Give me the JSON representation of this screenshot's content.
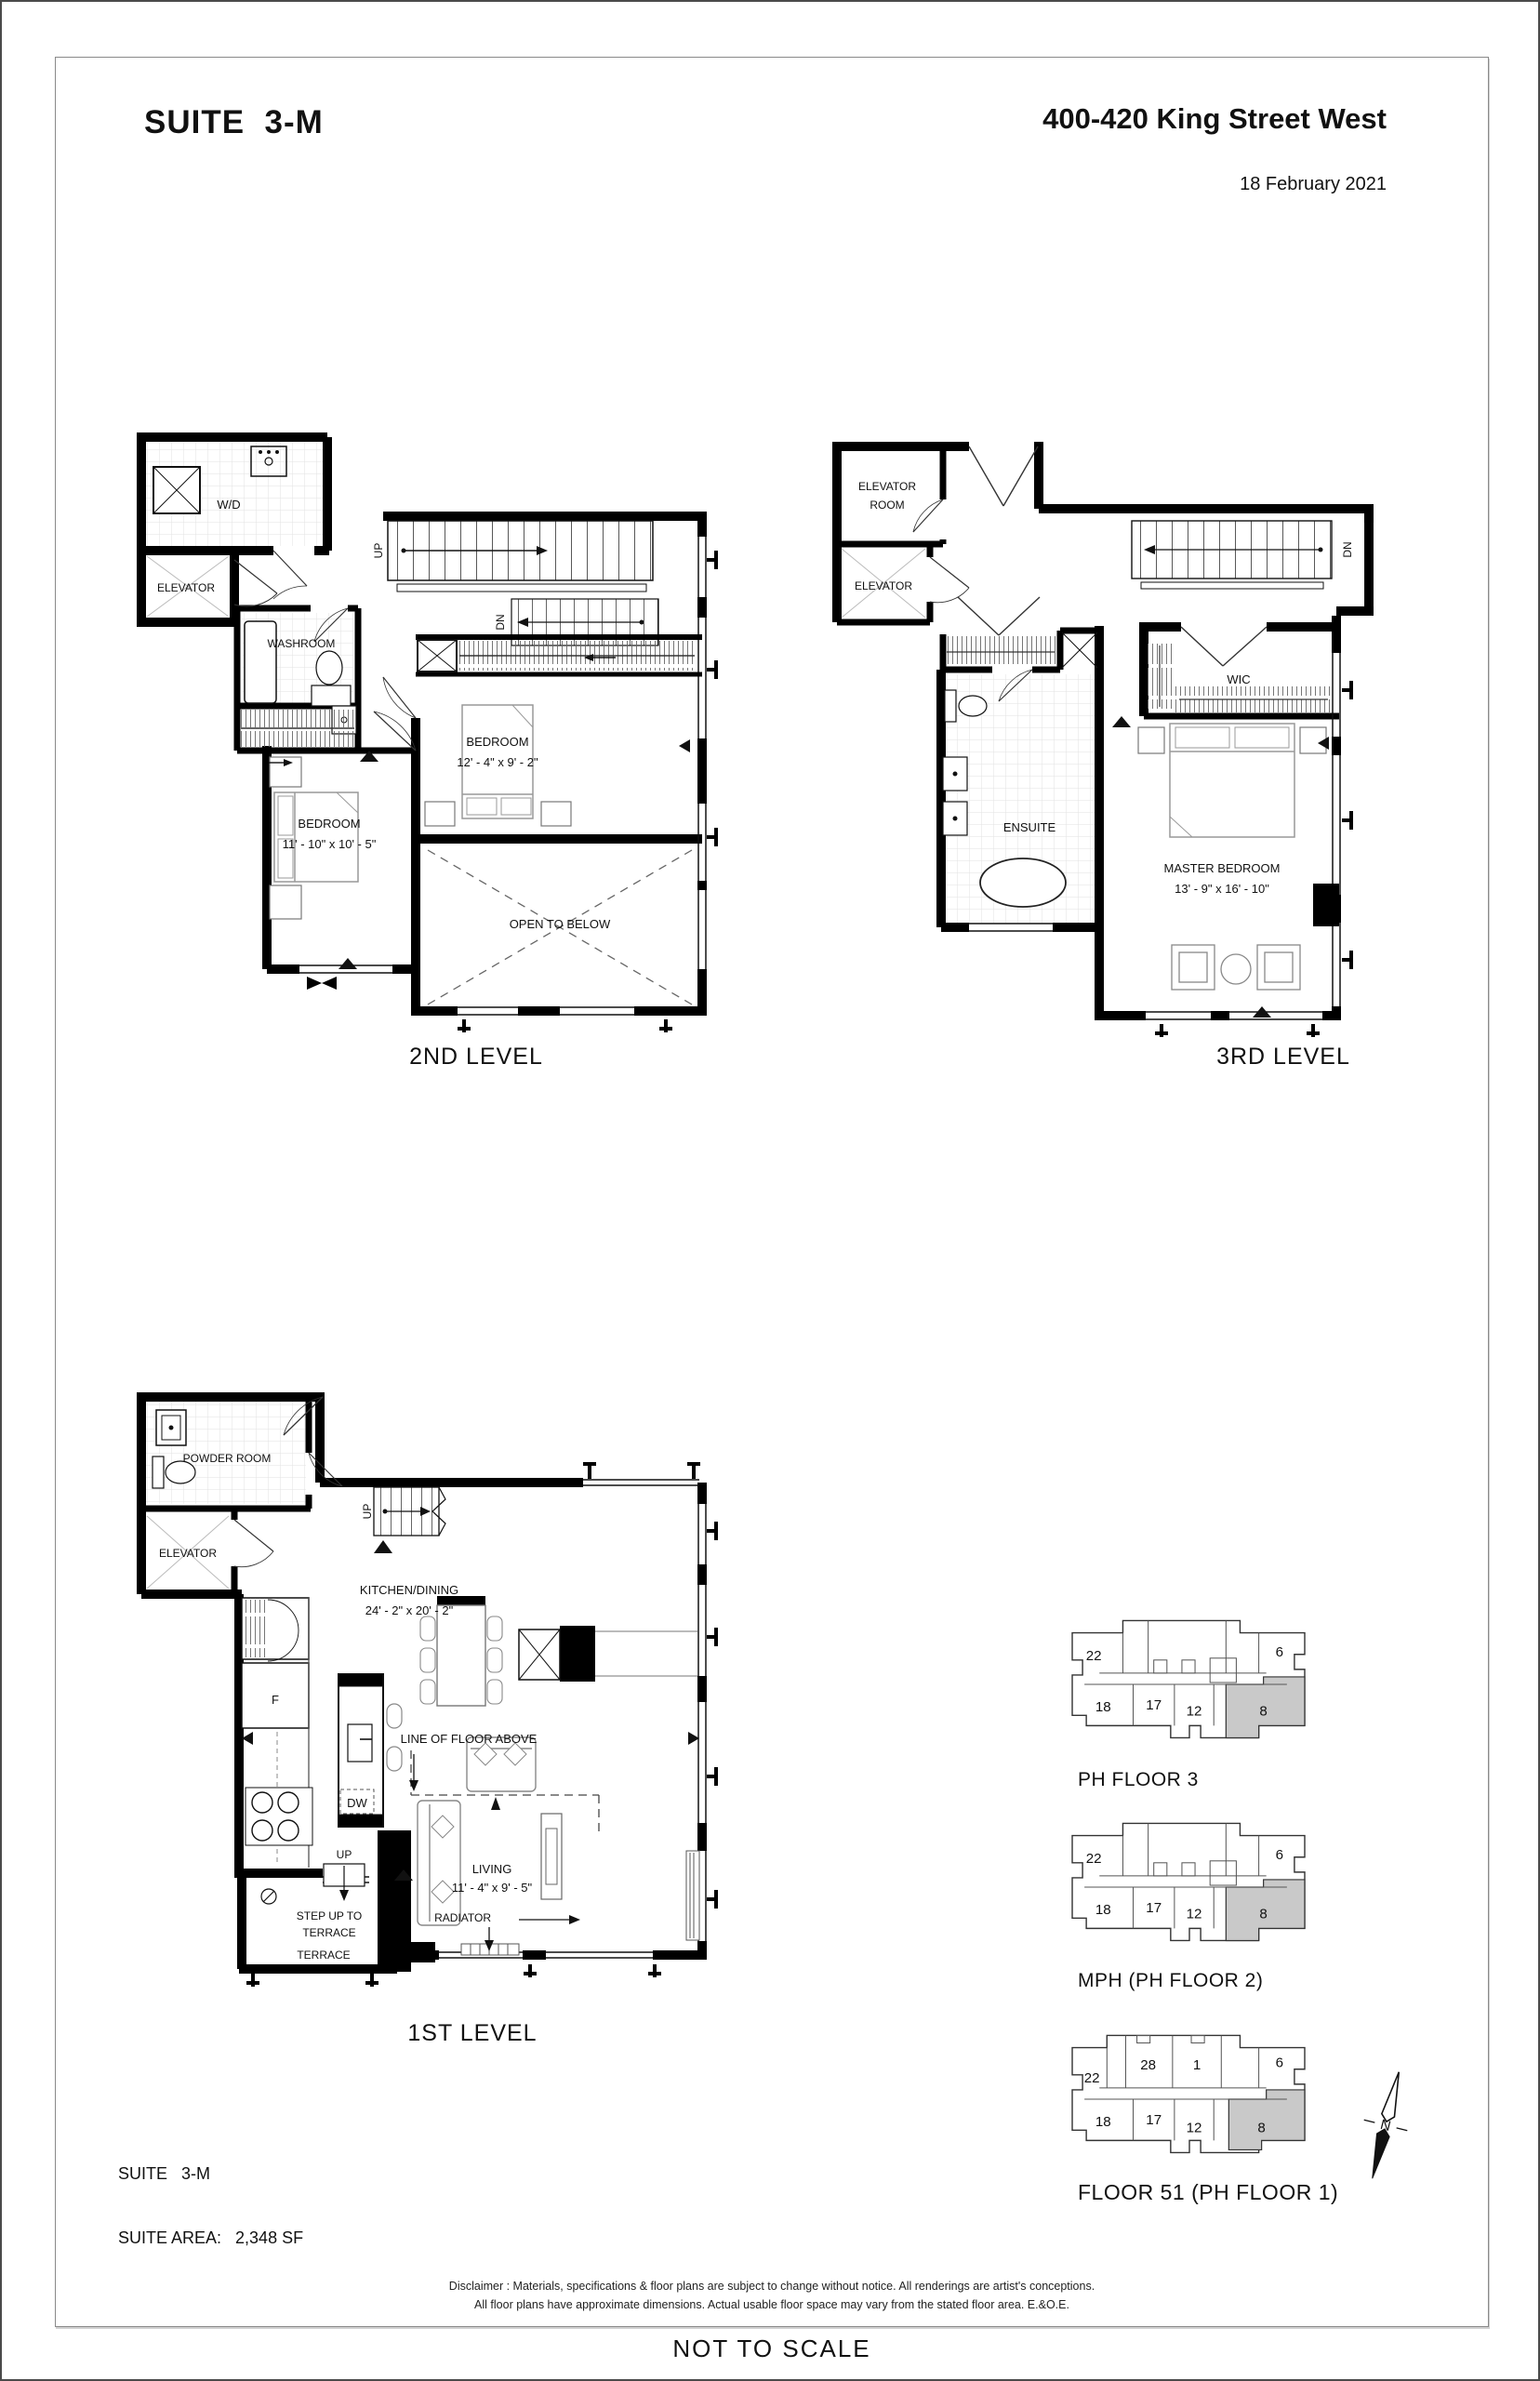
{
  "page": {
    "title": "SUITE  3-M",
    "address": "400-420 King Street West",
    "date": "18 February 2021",
    "not_to_scale": "NOT TO SCALE",
    "disclaimer": [
      "Disclaimer : Materials, specifications & floor plans are subject to change without notice. All renderings are artist's conceptions.",
      "All floor plans have approximate dimensions. Actual usable floor space may vary from the stated floor area. E.&O.E."
    ]
  },
  "suite_info": {
    "line1": "SUITE   3-M",
    "line2": "SUITE AREA:   2,348 SF"
  },
  "levels": {
    "second": {
      "title": "2ND LEVEL",
      "labels": {
        "wd": "W/D",
        "elevator": "ELEVATOR",
        "washroom": "WASHROOM",
        "up": "UP",
        "dn": "DN",
        "bedroom2_name": "BEDROOM",
        "bedroom2_dims": "12' - 4\"  x  9' - 2\"",
        "bedroom1_name": "BEDROOM",
        "bedroom1_dims": "11' - 10\"  x  10' - 5\"",
        "open_below": "OPEN TO BELOW"
      }
    },
    "third": {
      "title": "3RD LEVEL",
      "labels": {
        "elevator_room_line1": "ELEVATOR",
        "elevator_room_line2": "ROOM",
        "elevator": "ELEVATOR",
        "dn": "DN",
        "wic": "WIC",
        "ensuite": "ENSUITE",
        "master_name": "MASTER BEDROOM",
        "master_dims": "13' - 9\"  x  16' - 10\""
      }
    },
    "first": {
      "title": "1ST LEVEL",
      "labels": {
        "powder": "POWDER ROOM",
        "elevator": "ELEVATOR",
        "up_stairs": "UP",
        "kitchen_name": "KITCHEN/DINING",
        "kitchen_dims": "24' - 2\"  x  20' - 2\"",
        "fridge": "F",
        "dw": "DW",
        "line_above": "LINE OF FLOOR ABOVE",
        "living_name": "LIVING",
        "living_dims": "11' - 4\"  x  9' - 5\"",
        "radiator": "RADIATOR",
        "up_step": "UP",
        "step_line1": "STEP UP TO",
        "step_line2": "TERRACE",
        "terrace": "TERRACE"
      }
    }
  },
  "keyplans": [
    {
      "label": "PH FLOOR 3",
      "units": [
        "22",
        "6",
        "18",
        "17",
        "12",
        "8"
      ],
      "highlighted_unit": "8"
    },
    {
      "label": "MPH (PH FLOOR 2)",
      "units": [
        "22",
        "6",
        "18",
        "17",
        "12",
        "8"
      ],
      "highlighted_unit": "8"
    },
    {
      "label": "FLOOR 51 (PH FLOOR 1)",
      "units": [
        "22",
        "28",
        "1",
        "6",
        "18",
        "17",
        "12",
        "8"
      ],
      "highlighted_unit": "8"
    }
  ],
  "compass": {
    "north": "N"
  },
  "colors": {
    "wall": "#000000",
    "furniture": "#909090",
    "keyplan_highlight": "#c9c9c9"
  }
}
